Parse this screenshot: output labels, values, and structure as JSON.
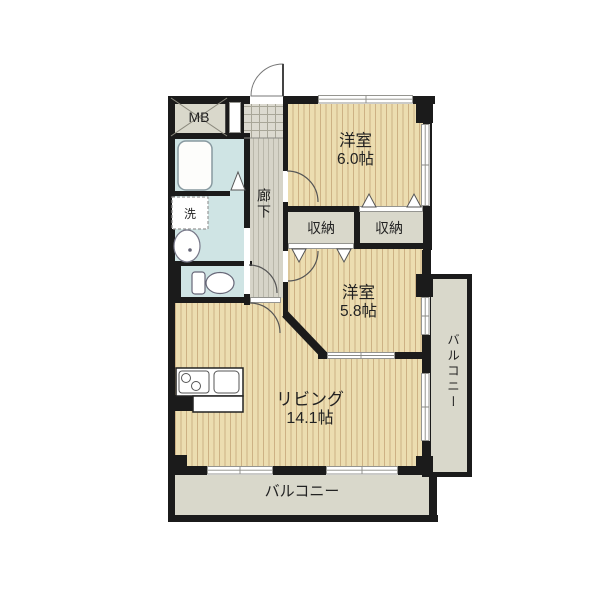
{
  "floor_plan": {
    "bedroom1": {
      "name": "洋室",
      "size": "6.0帖"
    },
    "bedroom2": {
      "name": "洋室",
      "size": "5.8帖"
    },
    "living": {
      "name": "リビング",
      "size": "14.1帖"
    },
    "closet_left": {
      "label": "収納"
    },
    "closet_right": {
      "label": "収納"
    },
    "hallway": {
      "label": "廊下"
    },
    "meter_box": {
      "label": "MB"
    },
    "laundry": {
      "label": "洗"
    },
    "balcony_south": {
      "label": "バルコニー"
    },
    "balcony_east": {
      "label": "バルコニー"
    },
    "colors": {
      "wall": "#1b1b1b",
      "wood_floor": "#ecddb0",
      "wood_stripe": "#cdb184",
      "wet_area": "#cfe4e4",
      "service_gray": "#d9d8cb",
      "hall_floor": "#d6d4c8",
      "background": "#ffffff"
    }
  }
}
